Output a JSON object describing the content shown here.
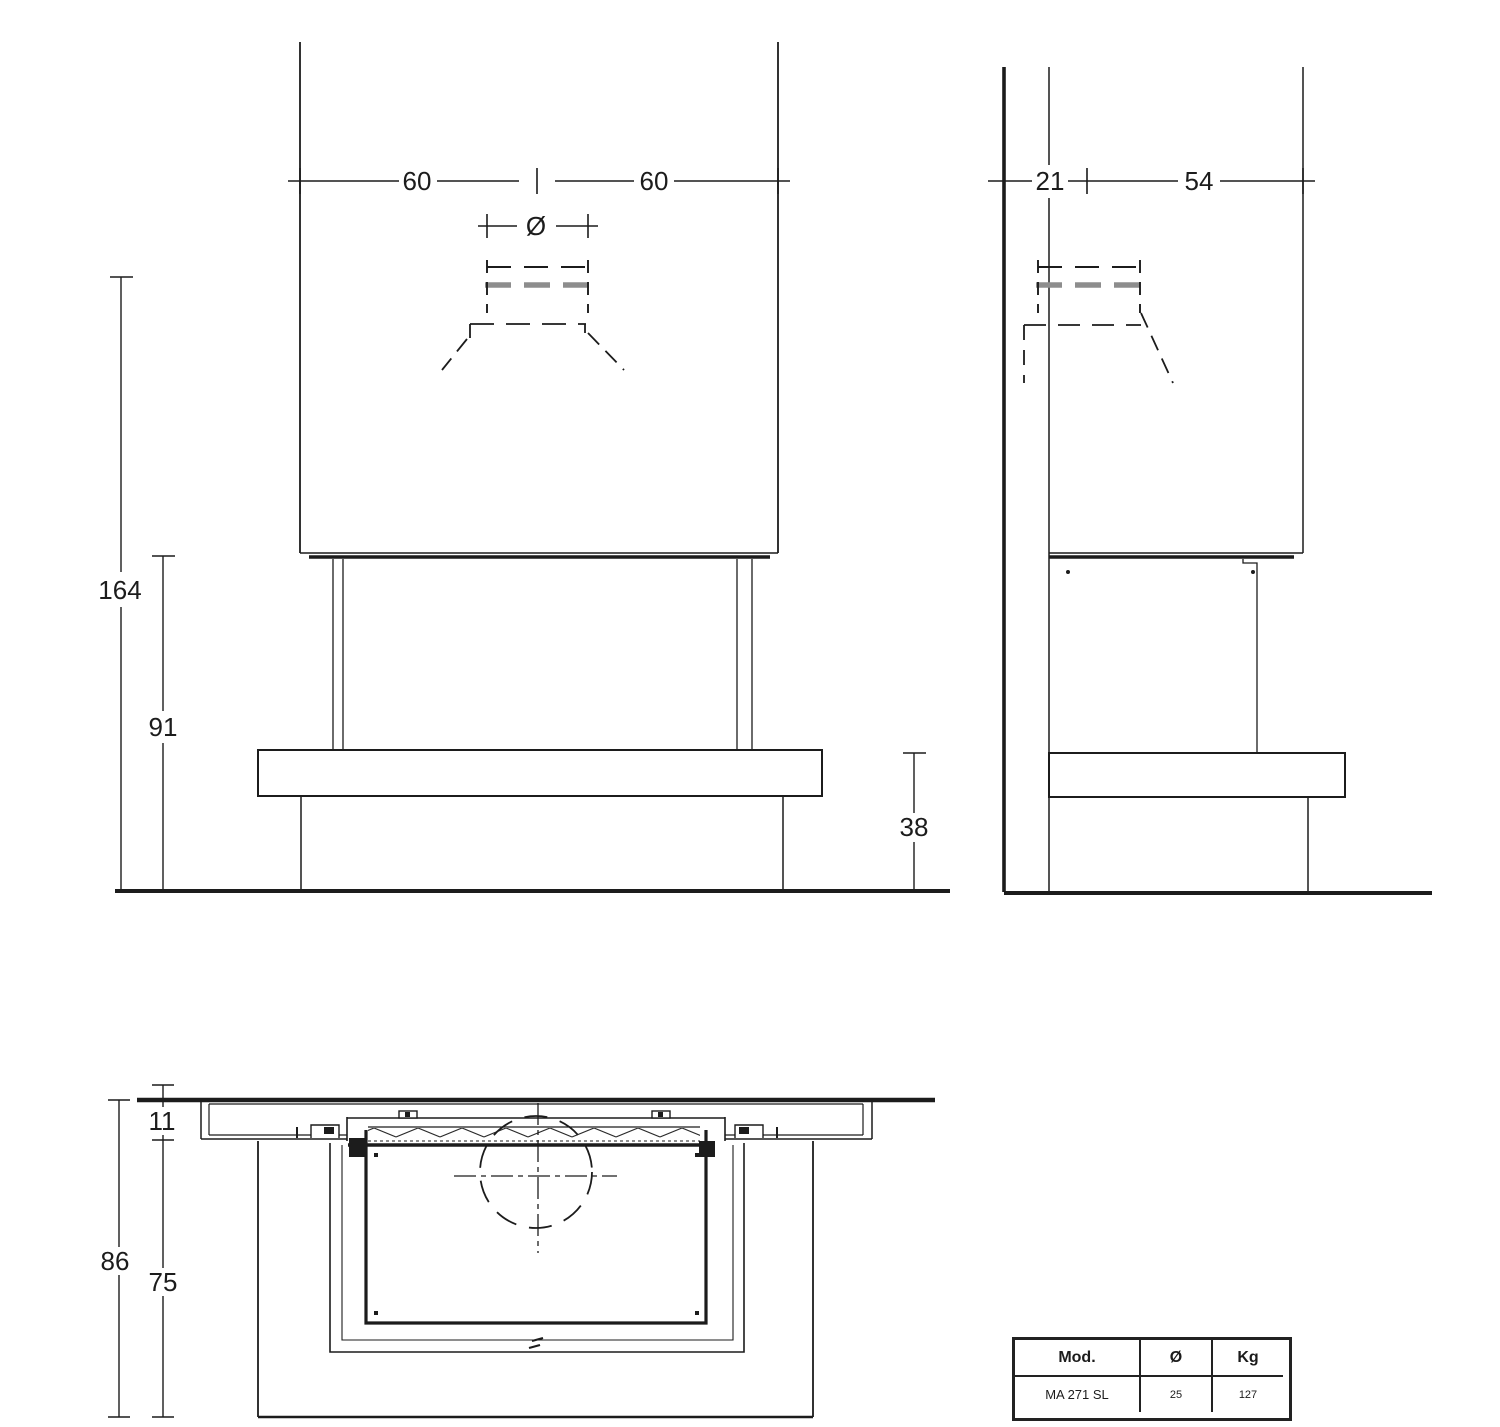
{
  "colors": {
    "line": "#1c1c1c",
    "gray_dash": "#8d8d8d",
    "background": "#ffffff"
  },
  "front_view": {
    "width_left": "60",
    "width_right": "60",
    "flue_diameter_symbol": "Ø",
    "total_height": "164",
    "opening_height": "91",
    "bench_height": "38"
  },
  "side_view": {
    "rear_depth": "21",
    "front_depth": "54"
  },
  "plan_view": {
    "wall_recess": "11",
    "total_depth": "86",
    "bench_depth": "75"
  },
  "spec_table": {
    "headers": [
      "Mod.",
      "Ø",
      "Kg"
    ],
    "row": [
      "MA 271 SL",
      "25",
      "127"
    ]
  }
}
